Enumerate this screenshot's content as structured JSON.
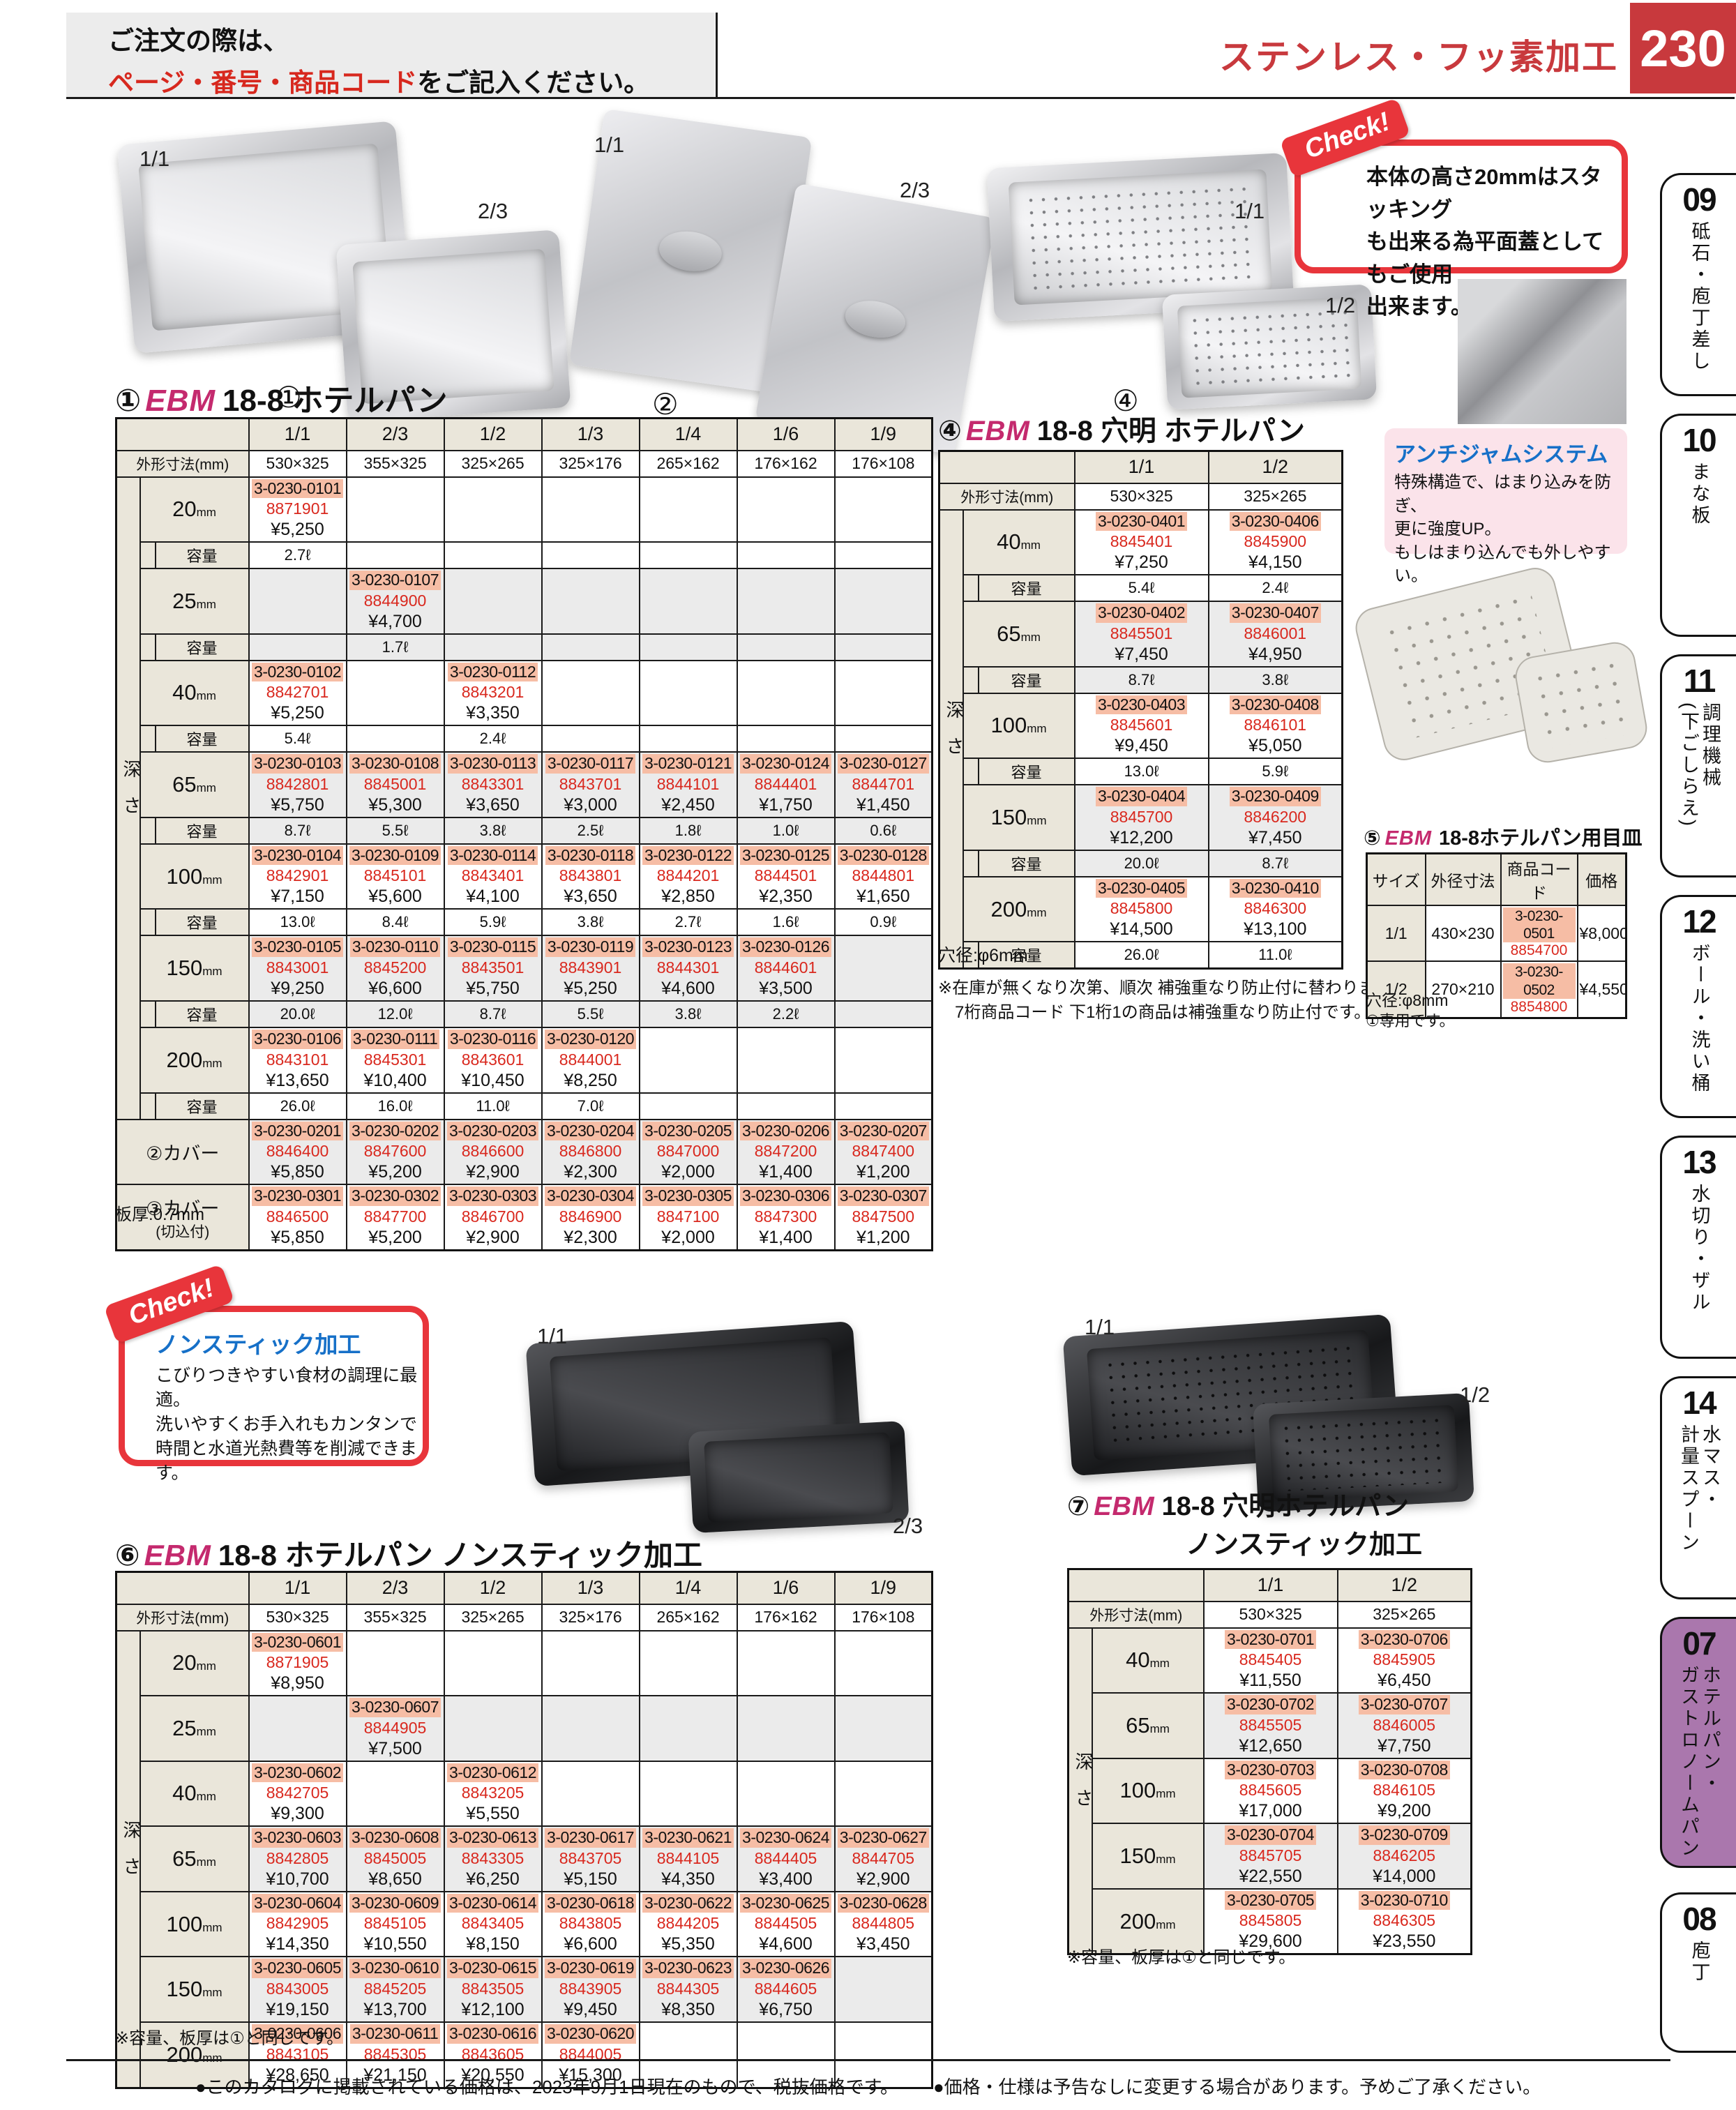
{
  "header": {
    "order_line1": "ご注文の際は、",
    "order_red": "ページ・番号・商品コード",
    "order_rest": "をご記入ください。",
    "category_title": "ステンレス・フッ素加工",
    "page_number": "230"
  },
  "sidebar": {
    "tabs": [
      {
        "num": "09",
        "label": "砥石・庖丁差し",
        "active": false
      },
      {
        "num": "10",
        "label": "まな板",
        "active": false
      },
      {
        "num": "11",
        "label": "調理機械\n(下ごしらえ)",
        "active": false
      },
      {
        "num": "12",
        "label": "ボール・洗い桶",
        "active": false
      },
      {
        "num": "13",
        "label": "水切り・ザル",
        "active": false
      },
      {
        "num": "14",
        "label": "水マス・\n計量スプーン",
        "active": false
      },
      {
        "num": "07",
        "label": "ホテルパン・\nガストロノームパン",
        "active": true
      },
      {
        "num": "08",
        "label": "庖丁",
        "active": false
      }
    ]
  },
  "images": {
    "pan11": "1/1",
    "pan23": "2/3",
    "circ1": "①",
    "cover11": "1/1",
    "cover23": "2/3",
    "circ2": "②",
    "circ3": "③",
    "perf11": "1/1",
    "perf12": "1/2",
    "circ4": "④",
    "ns11": "1/1",
    "ns23": "2/3",
    "nsp11": "1/1",
    "nsp12": "1/2"
  },
  "check1": {
    "badge": "Check!",
    "body": "本体の高さ20mmはスタッキング\nも出来る為平面蓋としてもご使用\n出来ます。"
  },
  "antijam": {
    "title": "アンチジャムシステム",
    "body": "特殊構造で、はまり込みを防ぎ、\n更に強度UP。\nもしはまり込んでも外しやすい。"
  },
  "check2": {
    "badge": "Check!",
    "title": "ノンスティック加工",
    "body": "こびりつきやすい食材の調理に最適。\n洗いやすくお手入れもカンタンで\n時間と水道光熱費等を削減できます。"
  },
  "table1": {
    "num": "①",
    "brand": "EBM",
    "name": "18-8 ホテルパン",
    "cols": [
      "1/1",
      "2/3",
      "1/2",
      "1/3",
      "1/4",
      "1/6",
      "1/9"
    ],
    "dims_header": "外形寸法(mm)",
    "dims": [
      "530×325",
      "355×325",
      "325×265",
      "325×176",
      "265×162",
      "176×162",
      "176×108"
    ],
    "depth_header": "深さ",
    "cap_label": "容量",
    "rows": [
      {
        "depth": "20",
        "unit": "mm",
        "cells": [
          [
            "3-0230-0101",
            "8871901",
            "¥5,250"
          ],
          null,
          null,
          null,
          null,
          null,
          null
        ],
        "caps": [
          "2.7ℓ",
          "",
          "",
          "",
          "",
          "",
          ""
        ]
      },
      {
        "depth": "25",
        "unit": "mm",
        "cells": [
          null,
          [
            "3-0230-0107",
            "8844900",
            "¥4,700"
          ],
          null,
          null,
          null,
          null,
          null
        ],
        "caps": [
          "",
          "1.7ℓ",
          "",
          "",
          "",
          "",
          ""
        ]
      },
      {
        "depth": "40",
        "unit": "mm",
        "cells": [
          [
            "3-0230-0102",
            "8842701",
            "¥5,250"
          ],
          null,
          [
            "3-0230-0112",
            "8843201",
            "¥3,350"
          ],
          null,
          null,
          null,
          null
        ],
        "caps": [
          "5.4ℓ",
          "",
          "2.4ℓ",
          "",
          "",
          "",
          ""
        ]
      },
      {
        "depth": "65",
        "unit": "mm",
        "cells": [
          [
            "3-0230-0103",
            "8842801",
            "¥5,750"
          ],
          [
            "3-0230-0108",
            "8845001",
            "¥5,300"
          ],
          [
            "3-0230-0113",
            "8843301",
            "¥3,650"
          ],
          [
            "3-0230-0117",
            "8843701",
            "¥3,000"
          ],
          [
            "3-0230-0121",
            "8844101",
            "¥2,450"
          ],
          [
            "3-0230-0124",
            "8844401",
            "¥1,750"
          ],
          [
            "3-0230-0127",
            "8844701",
            "¥1,450"
          ]
        ],
        "caps": [
          "8.7ℓ",
          "5.5ℓ",
          "3.8ℓ",
          "2.5ℓ",
          "1.8ℓ",
          "1.0ℓ",
          "0.6ℓ"
        ]
      },
      {
        "depth": "100",
        "unit": "mm",
        "cells": [
          [
            "3-0230-0104",
            "8842901",
            "¥7,150"
          ],
          [
            "3-0230-0109",
            "8845101",
            "¥5,600"
          ],
          [
            "3-0230-0114",
            "8843401",
            "¥4,100"
          ],
          [
            "3-0230-0118",
            "8843801",
            "¥3,650"
          ],
          [
            "3-0230-0122",
            "8844201",
            "¥2,850"
          ],
          [
            "3-0230-0125",
            "8844501",
            "¥2,350"
          ],
          [
            "3-0230-0128",
            "8844801",
            "¥1,650"
          ]
        ],
        "caps": [
          "13.0ℓ",
          "8.4ℓ",
          "5.9ℓ",
          "3.8ℓ",
          "2.7ℓ",
          "1.6ℓ",
          "0.9ℓ"
        ]
      },
      {
        "depth": "150",
        "unit": "mm",
        "cells": [
          [
            "3-0230-0105",
            "8843001",
            "¥9,250"
          ],
          [
            "3-0230-0110",
            "8845200",
            "¥6,600"
          ],
          [
            "3-0230-0115",
            "8843501",
            "¥5,750"
          ],
          [
            "3-0230-0119",
            "8843901",
            "¥5,250"
          ],
          [
            "3-0230-0123",
            "8844301",
            "¥4,600"
          ],
          [
            "3-0230-0126",
            "8844601",
            "¥3,500"
          ],
          null
        ],
        "caps": [
          "20.0ℓ",
          "12.0ℓ",
          "8.7ℓ",
          "5.5ℓ",
          "3.8ℓ",
          "2.2ℓ",
          ""
        ]
      },
      {
        "depth": "200",
        "unit": "mm",
        "cells": [
          [
            "3-0230-0106",
            "8843101",
            "¥13,650"
          ],
          [
            "3-0230-0111",
            "8845301",
            "¥10,400"
          ],
          [
            "3-0230-0116",
            "8843601",
            "¥10,450"
          ],
          [
            "3-0230-0120",
            "8844001",
            "¥8,250"
          ],
          null,
          null,
          null
        ],
        "caps": [
          "26.0ℓ",
          "16.0ℓ",
          "11.0ℓ",
          "7.0ℓ",
          "",
          "",
          ""
        ]
      }
    ],
    "covers": [
      {
        "label": "②カバー",
        "label2": "",
        "cells": [
          [
            "3-0230-0201",
            "8846400",
            "¥5,850"
          ],
          [
            "3-0230-0202",
            "8847600",
            "¥5,200"
          ],
          [
            "3-0230-0203",
            "8846600",
            "¥2,900"
          ],
          [
            "3-0230-0204",
            "8846800",
            "¥2,300"
          ],
          [
            "3-0230-0205",
            "8847000",
            "¥2,000"
          ],
          [
            "3-0230-0206",
            "8847200",
            "¥1,400"
          ],
          [
            "3-0230-0207",
            "8847400",
            "¥1,200"
          ]
        ]
      },
      {
        "label": "③カバー",
        "label2": "(切込付)",
        "cells": [
          [
            "3-0230-0301",
            "8846500",
            "¥5,850"
          ],
          [
            "3-0230-0302",
            "8847700",
            "¥5,200"
          ],
          [
            "3-0230-0303",
            "8846700",
            "¥2,900"
          ],
          [
            "3-0230-0304",
            "8846900",
            "¥2,300"
          ],
          [
            "3-0230-0305",
            "8847100",
            "¥2,000"
          ],
          [
            "3-0230-0306",
            "8847300",
            "¥1,400"
          ],
          [
            "3-0230-0307",
            "8847500",
            "¥1,200"
          ]
        ]
      }
    ],
    "note": "板厚:0.7mm"
  },
  "table4": {
    "num": "④",
    "brand": "EBM",
    "name": "18-8 穴明 ホテルパン",
    "cols": [
      "1/1",
      "1/2"
    ],
    "dims_header": "外形寸法(mm)",
    "dims": [
      "530×325",
      "325×265"
    ],
    "depth_header": "深さ",
    "cap_label": "容量",
    "rows": [
      {
        "depth": "40",
        "unit": "mm",
        "cells": [
          [
            "3-0230-0401",
            "8845401",
            "¥7,250"
          ],
          [
            "3-0230-0406",
            "8845900",
            "¥4,150"
          ]
        ],
        "caps": [
          "5.4ℓ",
          "2.4ℓ"
        ]
      },
      {
        "depth": "65",
        "unit": "mm",
        "cells": [
          [
            "3-0230-0402",
            "8845501",
            "¥7,450"
          ],
          [
            "3-0230-0407",
            "8846001",
            "¥4,950"
          ]
        ],
        "caps": [
          "8.7ℓ",
          "3.8ℓ"
        ]
      },
      {
        "depth": "100",
        "unit": "mm",
        "cells": [
          [
            "3-0230-0403",
            "8845601",
            "¥9,450"
          ],
          [
            "3-0230-0408",
            "8846101",
            "¥5,050"
          ]
        ],
        "caps": [
          "13.0ℓ",
          "5.9ℓ"
        ]
      },
      {
        "depth": "150",
        "unit": "mm",
        "cells": [
          [
            "3-0230-0404",
            "8845700",
            "¥12,200"
          ],
          [
            "3-0230-0409",
            "8846200",
            "¥7,450"
          ]
        ],
        "caps": [
          "20.0ℓ",
          "8.7ℓ"
        ]
      },
      {
        "depth": "200",
        "unit": "mm",
        "cells": [
          [
            "3-0230-0405",
            "8845800",
            "¥14,500"
          ],
          [
            "3-0230-0410",
            "8846300",
            "¥13,100"
          ]
        ],
        "caps": [
          "26.0ℓ",
          "11.0ℓ"
        ]
      }
    ],
    "note": "穴径:φ6mm",
    "note2": "※在庫が無くなり次第、順次 補強重なり防止付に替わります。\n　7桁商品コード 下1桁1の商品は補強重なり防止付です。"
  },
  "table5": {
    "num": "⑤",
    "brand": "EBM",
    "name": "18-8ホテルパン用目皿",
    "headers": [
      "サイズ",
      "外径寸法",
      "商品コード",
      "価格"
    ],
    "rows": [
      {
        "size": "1/1",
        "dim": "430×230",
        "code1": "3-0230-0501",
        "code2": "8854700",
        "price": "¥8,000"
      },
      {
        "size": "1/2",
        "dim": "270×210",
        "code1": "3-0230-0502",
        "code2": "8854800",
        "price": "¥4,550"
      }
    ],
    "note": "穴径:φ8mm",
    "note2": "①専用です。"
  },
  "table6": {
    "num": "⑥",
    "brand": "EBM",
    "name": "18-8 ホテルパン ノンスティック加工",
    "cols": [
      "1/1",
      "2/3",
      "1/2",
      "1/3",
      "1/4",
      "1/6",
      "1/9"
    ],
    "dims_header": "外形寸法(mm)",
    "dims": [
      "530×325",
      "355×325",
      "325×265",
      "325×176",
      "265×162",
      "176×162",
      "176×108"
    ],
    "depth_header": "深さ",
    "rows": [
      {
        "depth": "20",
        "unit": "mm",
        "cells": [
          [
            "3-0230-0601",
            "8871905",
            "¥8,950"
          ],
          null,
          null,
          null,
          null,
          null,
          null
        ]
      },
      {
        "depth": "25",
        "unit": "mm",
        "cells": [
          null,
          [
            "3-0230-0607",
            "8844905",
            "¥7,500"
          ],
          null,
          null,
          null,
          null,
          null
        ]
      },
      {
        "depth": "40",
        "unit": "mm",
        "cells": [
          [
            "3-0230-0602",
            "8842705",
            "¥9,300"
          ],
          null,
          [
            "3-0230-0612",
            "8843205",
            "¥5,550"
          ],
          null,
          null,
          null,
          null
        ]
      },
      {
        "depth": "65",
        "unit": "mm",
        "cells": [
          [
            "3-0230-0603",
            "8842805",
            "¥10,700"
          ],
          [
            "3-0230-0608",
            "8845005",
            "¥8,650"
          ],
          [
            "3-0230-0613",
            "8843305",
            "¥6,250"
          ],
          [
            "3-0230-0617",
            "8843705",
            "¥5,150"
          ],
          [
            "3-0230-0621",
            "8844105",
            "¥4,350"
          ],
          [
            "3-0230-0624",
            "8844405",
            "¥3,400"
          ],
          [
            "3-0230-0627",
            "8844705",
            "¥2,900"
          ]
        ]
      },
      {
        "depth": "100",
        "unit": "mm",
        "cells": [
          [
            "3-0230-0604",
            "8842905",
            "¥14,350"
          ],
          [
            "3-0230-0609",
            "8845105",
            "¥10,550"
          ],
          [
            "3-0230-0614",
            "8843405",
            "¥8,150"
          ],
          [
            "3-0230-0618",
            "8843805",
            "¥6,600"
          ],
          [
            "3-0230-0622",
            "8844205",
            "¥5,350"
          ],
          [
            "3-0230-0625",
            "8844505",
            "¥4,600"
          ],
          [
            "3-0230-0628",
            "8844805",
            "¥3,450"
          ]
        ]
      },
      {
        "depth": "150",
        "unit": "mm",
        "cells": [
          [
            "3-0230-0605",
            "8843005",
            "¥19,150"
          ],
          [
            "3-0230-0610",
            "8845205",
            "¥13,700"
          ],
          [
            "3-0230-0615",
            "8843505",
            "¥12,100"
          ],
          [
            "3-0230-0619",
            "8843905",
            "¥9,450"
          ],
          [
            "3-0230-0623",
            "8844305",
            "¥8,350"
          ],
          [
            "3-0230-0626",
            "8844605",
            "¥6,750"
          ],
          null
        ]
      },
      {
        "depth": "200",
        "unit": "mm",
        "cells": [
          [
            "3-0230-0606",
            "8843105",
            "¥28,650"
          ],
          [
            "3-0230-0611",
            "8845305",
            "¥21,150"
          ],
          [
            "3-0230-0616",
            "8843605",
            "¥20,550"
          ],
          [
            "3-0230-0620",
            "8844005",
            "¥15,300"
          ],
          null,
          null,
          null
        ]
      }
    ],
    "note": "※容量、板厚は①と同じです。"
  },
  "table7": {
    "num": "⑦",
    "brand": "EBM",
    "name1": "18-8 穴明ホテルパン",
    "name2": "ノンスティック加工",
    "cols": [
      "1/1",
      "1/2"
    ],
    "dims_header": "外形寸法(mm)",
    "dims": [
      "530×325",
      "325×265"
    ],
    "depth_header": "深さ",
    "rows": [
      {
        "depth": "40",
        "unit": "mm",
        "cells": [
          [
            "3-0230-0701",
            "8845405",
            "¥11,550"
          ],
          [
            "3-0230-0706",
            "8845905",
            "¥6,450"
          ]
        ]
      },
      {
        "depth": "65",
        "unit": "mm",
        "cells": [
          [
            "3-0230-0702",
            "8845505",
            "¥12,650"
          ],
          [
            "3-0230-0707",
            "8846005",
            "¥7,750"
          ]
        ]
      },
      {
        "depth": "100",
        "unit": "mm",
        "cells": [
          [
            "3-0230-0703",
            "8845605",
            "¥17,000"
          ],
          [
            "3-0230-0708",
            "8846105",
            "¥9,200"
          ]
        ]
      },
      {
        "depth": "150",
        "unit": "mm",
        "cells": [
          [
            "3-0230-0704",
            "8845705",
            "¥22,550"
          ],
          [
            "3-0230-0709",
            "8846205",
            "¥14,000"
          ]
        ]
      },
      {
        "depth": "200",
        "unit": "mm",
        "cells": [
          [
            "3-0230-0705",
            "8845805",
            "¥29,600"
          ],
          [
            "3-0230-0710",
            "8846305",
            "¥23,550"
          ]
        ]
      }
    ],
    "note": "※容量、板厚は①と同じです。"
  },
  "footer": {
    "left": "●このカタログに掲載されている価格は、2023年9月1日現在のもので、税抜価格です。",
    "right": "●価格・仕様は予告なしに変更する場合があります。予めご了承ください。"
  }
}
